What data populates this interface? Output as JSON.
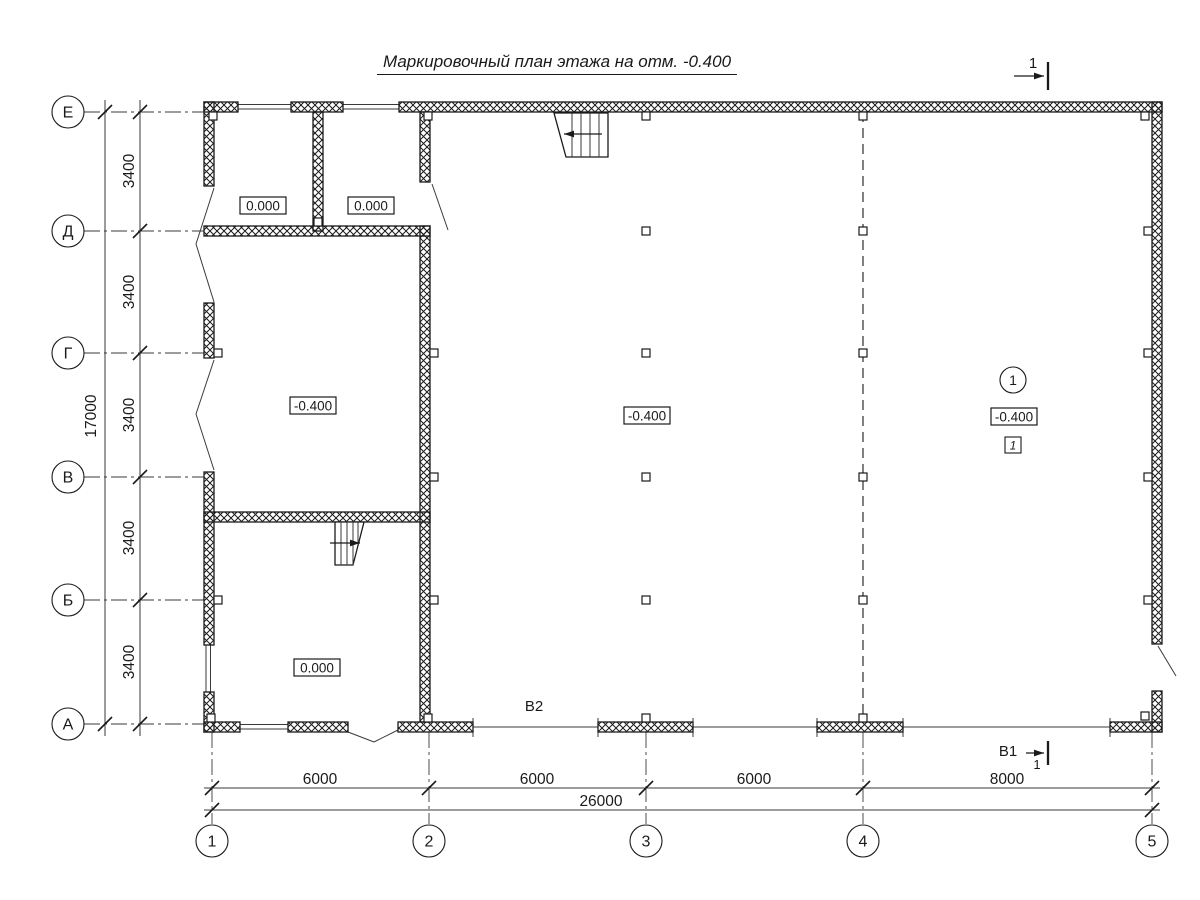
{
  "title": "Маркировочный план этажа на отм. -0.400",
  "colors": {
    "ink": "#1a1a1a",
    "thin": "#3a3a3a",
    "bg": "#ffffff"
  },
  "annotations": {
    "b2": "В2"
  },
  "section_marks": {
    "top": {
      "label": "1"
    },
    "bottom": {
      "label": "В1",
      "sub": "1"
    }
  },
  "axes": {
    "rows": [
      {
        "label": "Е",
        "y": 112
      },
      {
        "label": "Д",
        "y": 231
      },
      {
        "label": "Г",
        "y": 353
      },
      {
        "label": "В",
        "y": 477
      },
      {
        "label": "Б",
        "y": 600
      },
      {
        "label": "А",
        "y": 724
      }
    ],
    "cols": [
      {
        "label": "1",
        "x": 212
      },
      {
        "label": "2",
        "x": 429
      },
      {
        "label": "3",
        "x": 646
      },
      {
        "label": "4",
        "x": 863
      },
      {
        "label": "5",
        "x": 1152
      }
    ],
    "row_circle_cx": 68,
    "col_circle_cy": 841,
    "circle_r": 16
  },
  "dims": {
    "row_segments": [
      {
        "text": "3400",
        "y": 171
      },
      {
        "text": "3400",
        "y": 292
      },
      {
        "text": "3400",
        "y": 415
      },
      {
        "text": "3400",
        "y": 538
      },
      {
        "text": "3400",
        "y": 662
      }
    ],
    "row_total": {
      "text": "17000",
      "x": 96,
      "y": 416
    },
    "col_segments": [
      {
        "text": "6000",
        "x": 320
      },
      {
        "text": "6000",
        "x": 537
      },
      {
        "text": "6000",
        "x": 754
      },
      {
        "text": "8000",
        "x": 1007
      }
    ],
    "col_total": {
      "text": "26000",
      "x": 601,
      "y": 806
    }
  },
  "elevation_marks": [
    {
      "text": "0.000",
      "cx": 263,
      "cy": 206
    },
    {
      "text": "0.000",
      "cx": 371,
      "cy": 206
    },
    {
      "text": "-0.400",
      "cx": 313,
      "cy": 406
    },
    {
      "text": "-0.400",
      "cx": 647,
      "cy": 416
    },
    {
      "text": "-0.400",
      "cx": 1014,
      "cy": 417
    },
    {
      "text": "0.000",
      "cx": 317,
      "cy": 668
    }
  ],
  "zone_mark": {
    "circle_text": "1",
    "cx": 1013,
    "cy": 380,
    "r": 13,
    "box_text": "1",
    "box_cx": 1013,
    "box_cy": 445
  },
  "stairs": [
    {
      "outline": [
        [
          554,
          113
        ],
        [
          608,
          113
        ],
        [
          608,
          157
        ],
        [
          566,
          157
        ]
      ],
      "treads": [
        [
          572,
          113,
          572,
          157
        ],
        [
          581,
          113,
          581,
          157
        ],
        [
          590,
          113,
          590,
          157
        ],
        [
          599,
          113,
          599,
          157
        ]
      ],
      "arrow": [
        602,
        134,
        564,
        134
      ]
    },
    {
      "outline": [
        [
          335,
          522
        ],
        [
          364,
          522
        ],
        [
          353,
          565
        ],
        [
          335,
          565
        ]
      ],
      "treads": [
        [
          341,
          522,
          341,
          565
        ],
        [
          347,
          522,
          347,
          565
        ],
        [
          353,
          522,
          353,
          565
        ],
        [
          358,
          522,
          358,
          544
        ]
      ],
      "arrow": [
        330,
        543,
        360,
        543
      ]
    }
  ],
  "geometry": {
    "axis_lines": [
      [
        84,
        112,
        204,
        112
      ],
      [
        84,
        231,
        204,
        231
      ],
      [
        84,
        353,
        204,
        353
      ],
      [
        84,
        477,
        204,
        477
      ],
      [
        84,
        600,
        204,
        600
      ],
      [
        84,
        724,
        204,
        724
      ],
      [
        212,
        732,
        212,
        824
      ],
      [
        429,
        732,
        429,
        824
      ],
      [
        646,
        732,
        646,
        824
      ],
      [
        863,
        732,
        863,
        824
      ],
      [
        1152,
        732,
        1152,
        824
      ]
    ],
    "dashed_lines": [
      [
        863,
        112,
        863,
        722
      ]
    ],
    "dim_lines": [
      [
        105,
        100,
        105,
        736
      ],
      [
        140,
        100,
        140,
        736
      ],
      [
        204,
        788,
        1160,
        788
      ],
      [
        204,
        810,
        1160,
        810
      ]
    ],
    "ticks": [
      [
        212,
        788
      ],
      [
        429,
        788
      ],
      [
        646,
        788
      ],
      [
        863,
        788
      ],
      [
        1152,
        788
      ],
      [
        212,
        810
      ],
      [
        1152,
        810
      ],
      [
        105,
        112
      ],
      [
        105,
        724
      ],
      [
        140,
        112
      ],
      [
        140,
        231
      ],
      [
        140,
        353
      ],
      [
        140,
        477
      ],
      [
        140,
        600
      ],
      [
        140,
        724
      ]
    ],
    "wall_rects": [
      [
        204,
        102,
        34,
        10
      ],
      [
        291,
        102,
        52,
        10
      ],
      [
        399,
        102,
        763,
        10
      ],
      [
        204,
        102,
        10,
        84
      ],
      [
        204,
        303,
        10,
        55
      ],
      [
        204,
        472,
        10,
        173
      ],
      [
        204,
        692,
        10,
        40
      ],
      [
        1152,
        102,
        10,
        542
      ],
      [
        1152,
        691,
        10,
        41
      ],
      [
        204,
        722,
        36,
        10
      ],
      [
        288,
        722,
        60,
        10
      ],
      [
        398,
        722,
        75,
        10
      ],
      [
        598,
        722,
        95,
        10
      ],
      [
        817,
        722,
        86,
        10
      ],
      [
        1110,
        722,
        52,
        10
      ],
      [
        420,
        112,
        10,
        70
      ],
      [
        420,
        226,
        10,
        496
      ],
      [
        313,
        112,
        10,
        119
      ],
      [
        204,
        226,
        226,
        10
      ],
      [
        204,
        512,
        226,
        10
      ]
    ],
    "pilasters": [
      [
        209,
        112,
        8,
        8
      ],
      [
        424,
        112,
        8,
        8
      ],
      [
        642,
        112,
        8,
        8
      ],
      [
        859,
        112,
        8,
        8
      ],
      [
        1141,
        112,
        8,
        8
      ],
      [
        207,
        714,
        8,
        8
      ],
      [
        424,
        714,
        8,
        8
      ],
      [
        642,
        714,
        8,
        8
      ],
      [
        859,
        714,
        8,
        8
      ],
      [
        1141,
        712,
        8,
        8
      ],
      [
        214,
        349,
        8,
        8
      ],
      [
        214,
        596,
        8,
        8
      ],
      [
        430,
        349,
        8,
        8
      ],
      [
        430,
        473,
        8,
        8
      ],
      [
        430,
        596,
        8,
        8
      ],
      [
        642,
        227,
        8,
        8
      ],
      [
        642,
        349,
        8,
        8
      ],
      [
        642,
        473,
        8,
        8
      ],
      [
        642,
        596,
        8,
        8
      ],
      [
        859,
        227,
        8,
        8
      ],
      [
        859,
        349,
        8,
        8
      ],
      [
        859,
        473,
        8,
        8
      ],
      [
        859,
        596,
        8,
        8
      ],
      [
        1144,
        227,
        8,
        8
      ],
      [
        1144,
        349,
        8,
        8
      ],
      [
        1144,
        473,
        8,
        8
      ],
      [
        1144,
        596,
        8,
        8
      ],
      [
        314,
        218,
        8,
        8
      ]
    ],
    "thin_lines": [
      [
        238,
        104.5,
        291,
        104.5
      ],
      [
        238,
        109,
        291,
        109
      ],
      [
        343,
        104.5,
        399,
        104.5
      ],
      [
        343,
        109,
        399,
        109
      ],
      [
        206,
        645,
        206,
        692
      ],
      [
        210.5,
        645,
        210.5,
        692
      ],
      [
        240,
        724.5,
        288,
        724.5
      ],
      [
        240,
        729,
        288,
        729
      ],
      [
        214,
        188,
        196,
        244
      ],
      [
        196,
        244,
        214,
        302
      ],
      [
        214,
        360,
        196,
        414
      ],
      [
        196,
        414,
        214,
        470
      ],
      [
        348,
        732,
        374,
        742
      ],
      [
        374,
        742,
        398,
        730
      ],
      [
        1158,
        646,
        1176,
        676
      ],
      [
        432,
        184,
        448,
        230
      ],
      [
        473,
        718,
        473,
        737
      ],
      [
        598,
        718,
        598,
        737
      ],
      [
        693,
        718,
        693,
        737
      ],
      [
        817,
        718,
        817,
        737
      ],
      [
        903,
        718,
        903,
        737
      ],
      [
        1110,
        718,
        1110,
        737
      ],
      [
        473,
        727,
        598,
        727
      ],
      [
        693,
        727,
        817,
        727
      ],
      [
        903,
        727,
        1110,
        727
      ]
    ],
    "section_arrows": [
      [
        1014,
        76,
        1044,
        76
      ],
      [
        1026,
        753,
        1044,
        753
      ]
    ],
    "section_bars": [
      [
        1048,
        62,
        1048,
        90
      ],
      [
        1048,
        741,
        1048,
        765
      ]
    ]
  }
}
